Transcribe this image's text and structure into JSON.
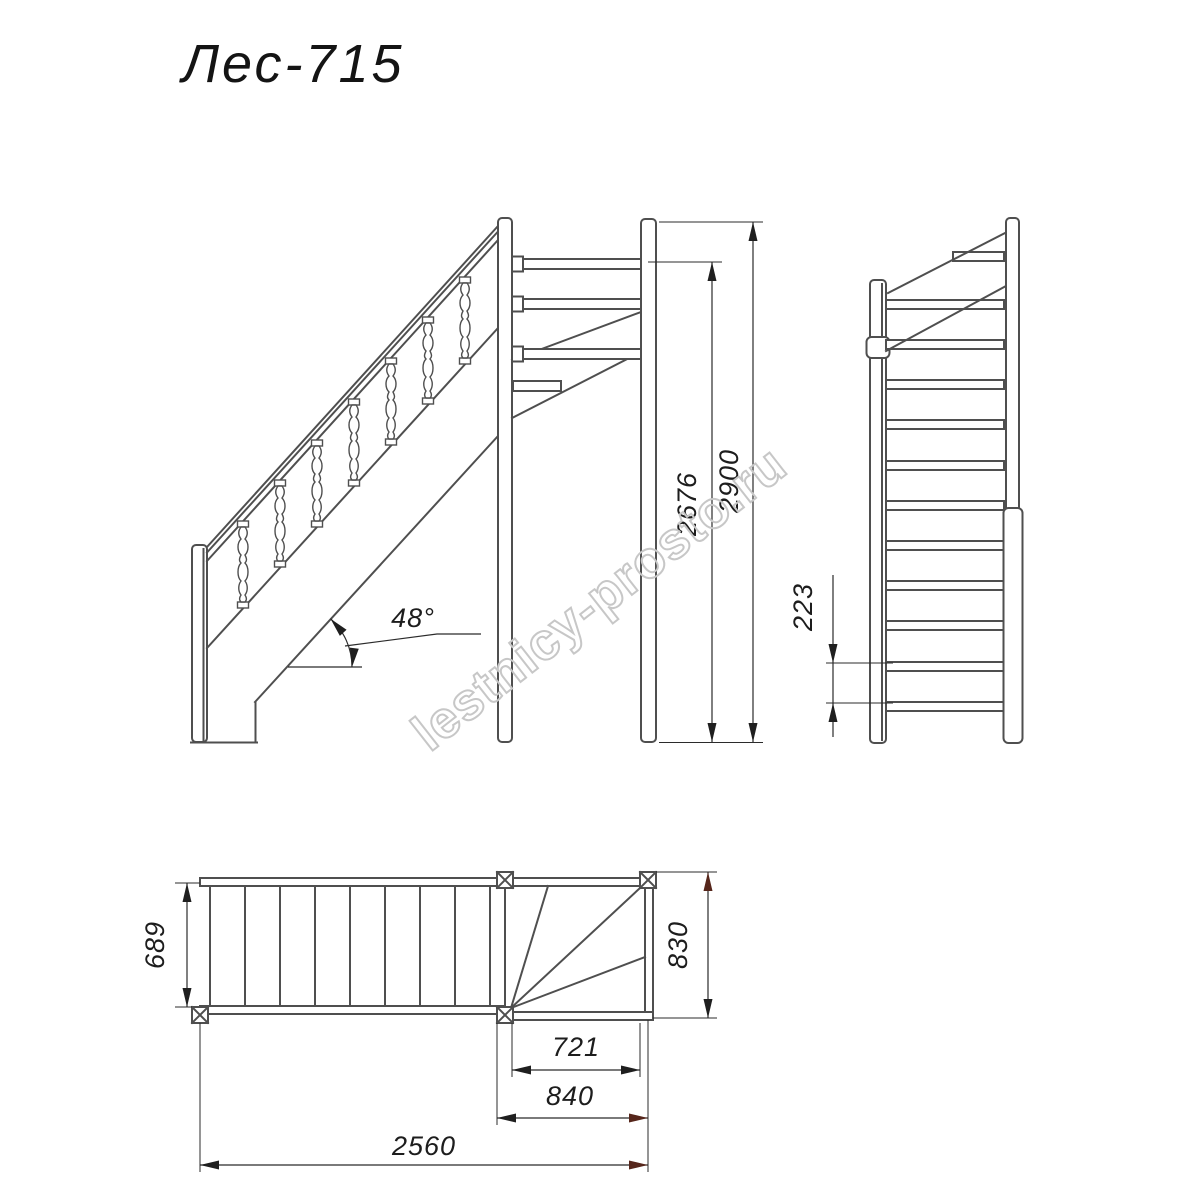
{
  "title": "Лес-715",
  "watermark": "lestnicy-prosto.ru",
  "views": {
    "front": {
      "angle": "48°",
      "dims": {
        "inner_height": "2676",
        "total_height": "2900"
      }
    },
    "side": {
      "dims": {
        "riser": "223"
      }
    },
    "plan": {
      "dims": {
        "flight_width": "689",
        "winder_width": "830",
        "inner_run": "721",
        "outer_run": "840",
        "total_run": "2560"
      }
    }
  },
  "colors": {
    "line": "#4f4f4f",
    "dim_line": "#2b2b2b",
    "text": "#1d1d1d",
    "accent_arrow": "#56261b",
    "watermark": "#c7c7c7",
    "background": "#ffffff"
  }
}
